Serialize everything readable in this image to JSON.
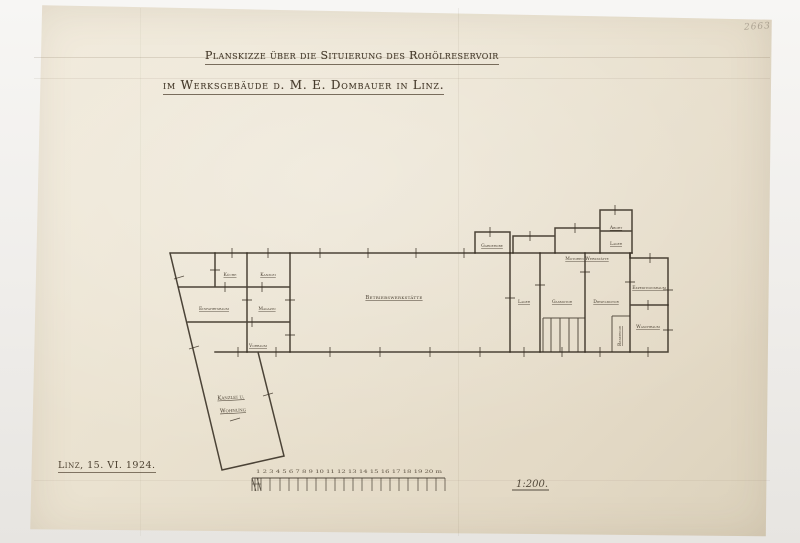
{
  "meta": {
    "paper_color": "#eae2d0",
    "ink_color": "#342c21",
    "pencil_note": "2663"
  },
  "title": {
    "line1": "Planskizze über die Situierung des Rohölreservoir",
    "line2": "im Werksgebäude d. M. E. Dombauer in Linz."
  },
  "plan": {
    "rooms": [
      {
        "label": "Küche"
      },
      {
        "label": "Kanzlei"
      },
      {
        "label": "Einfahrtsraum"
      },
      {
        "label": "Magazin"
      },
      {
        "label": "Vorraum"
      },
      {
        "label": "Kanzlei u.",
        "label2": "Wohnung"
      },
      {
        "label": "Betriebswerkstätte"
      },
      {
        "label": "Lager"
      },
      {
        "label": "Gasmotor"
      },
      {
        "label": "Dieselmotor"
      },
      {
        "label": "Garderobe"
      },
      {
        "label": "Abort"
      },
      {
        "label": "Lager"
      },
      {
        "label": "Motoren Werkstätte"
      },
      {
        "label": "Expeditionsraum"
      },
      {
        "label": "Waschraum"
      },
      {
        "label": "Reservoir"
      }
    ]
  },
  "footer": {
    "place_date": "Linz, 15. VI. 1924.",
    "scale": "1:200.",
    "scale_numbers": "1 2 3 4 5 6 7 8 9 10 11 12 13 14 15 16 17 18 19 20 m"
  }
}
